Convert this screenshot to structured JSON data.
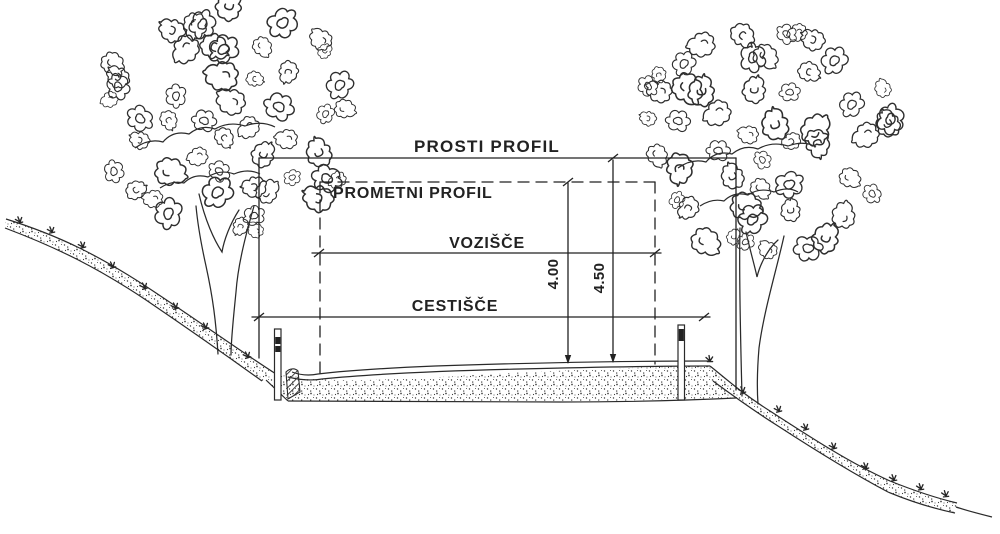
{
  "drawing": {
    "type": "road-cross-section-profile",
    "labels": {
      "prosti_profil": "PROSTI PROFIL",
      "prometni_profil": "PROMETNI PROFIL",
      "vozisce": "VOZIŠČE",
      "cestisce": "CESTIŠČE"
    },
    "dimensions": {
      "prometni_profil_height": "4.00",
      "prosti_profil_height": "4.50"
    },
    "colors": {
      "ink": "#222222",
      "paper": "#ffffff"
    }
  }
}
